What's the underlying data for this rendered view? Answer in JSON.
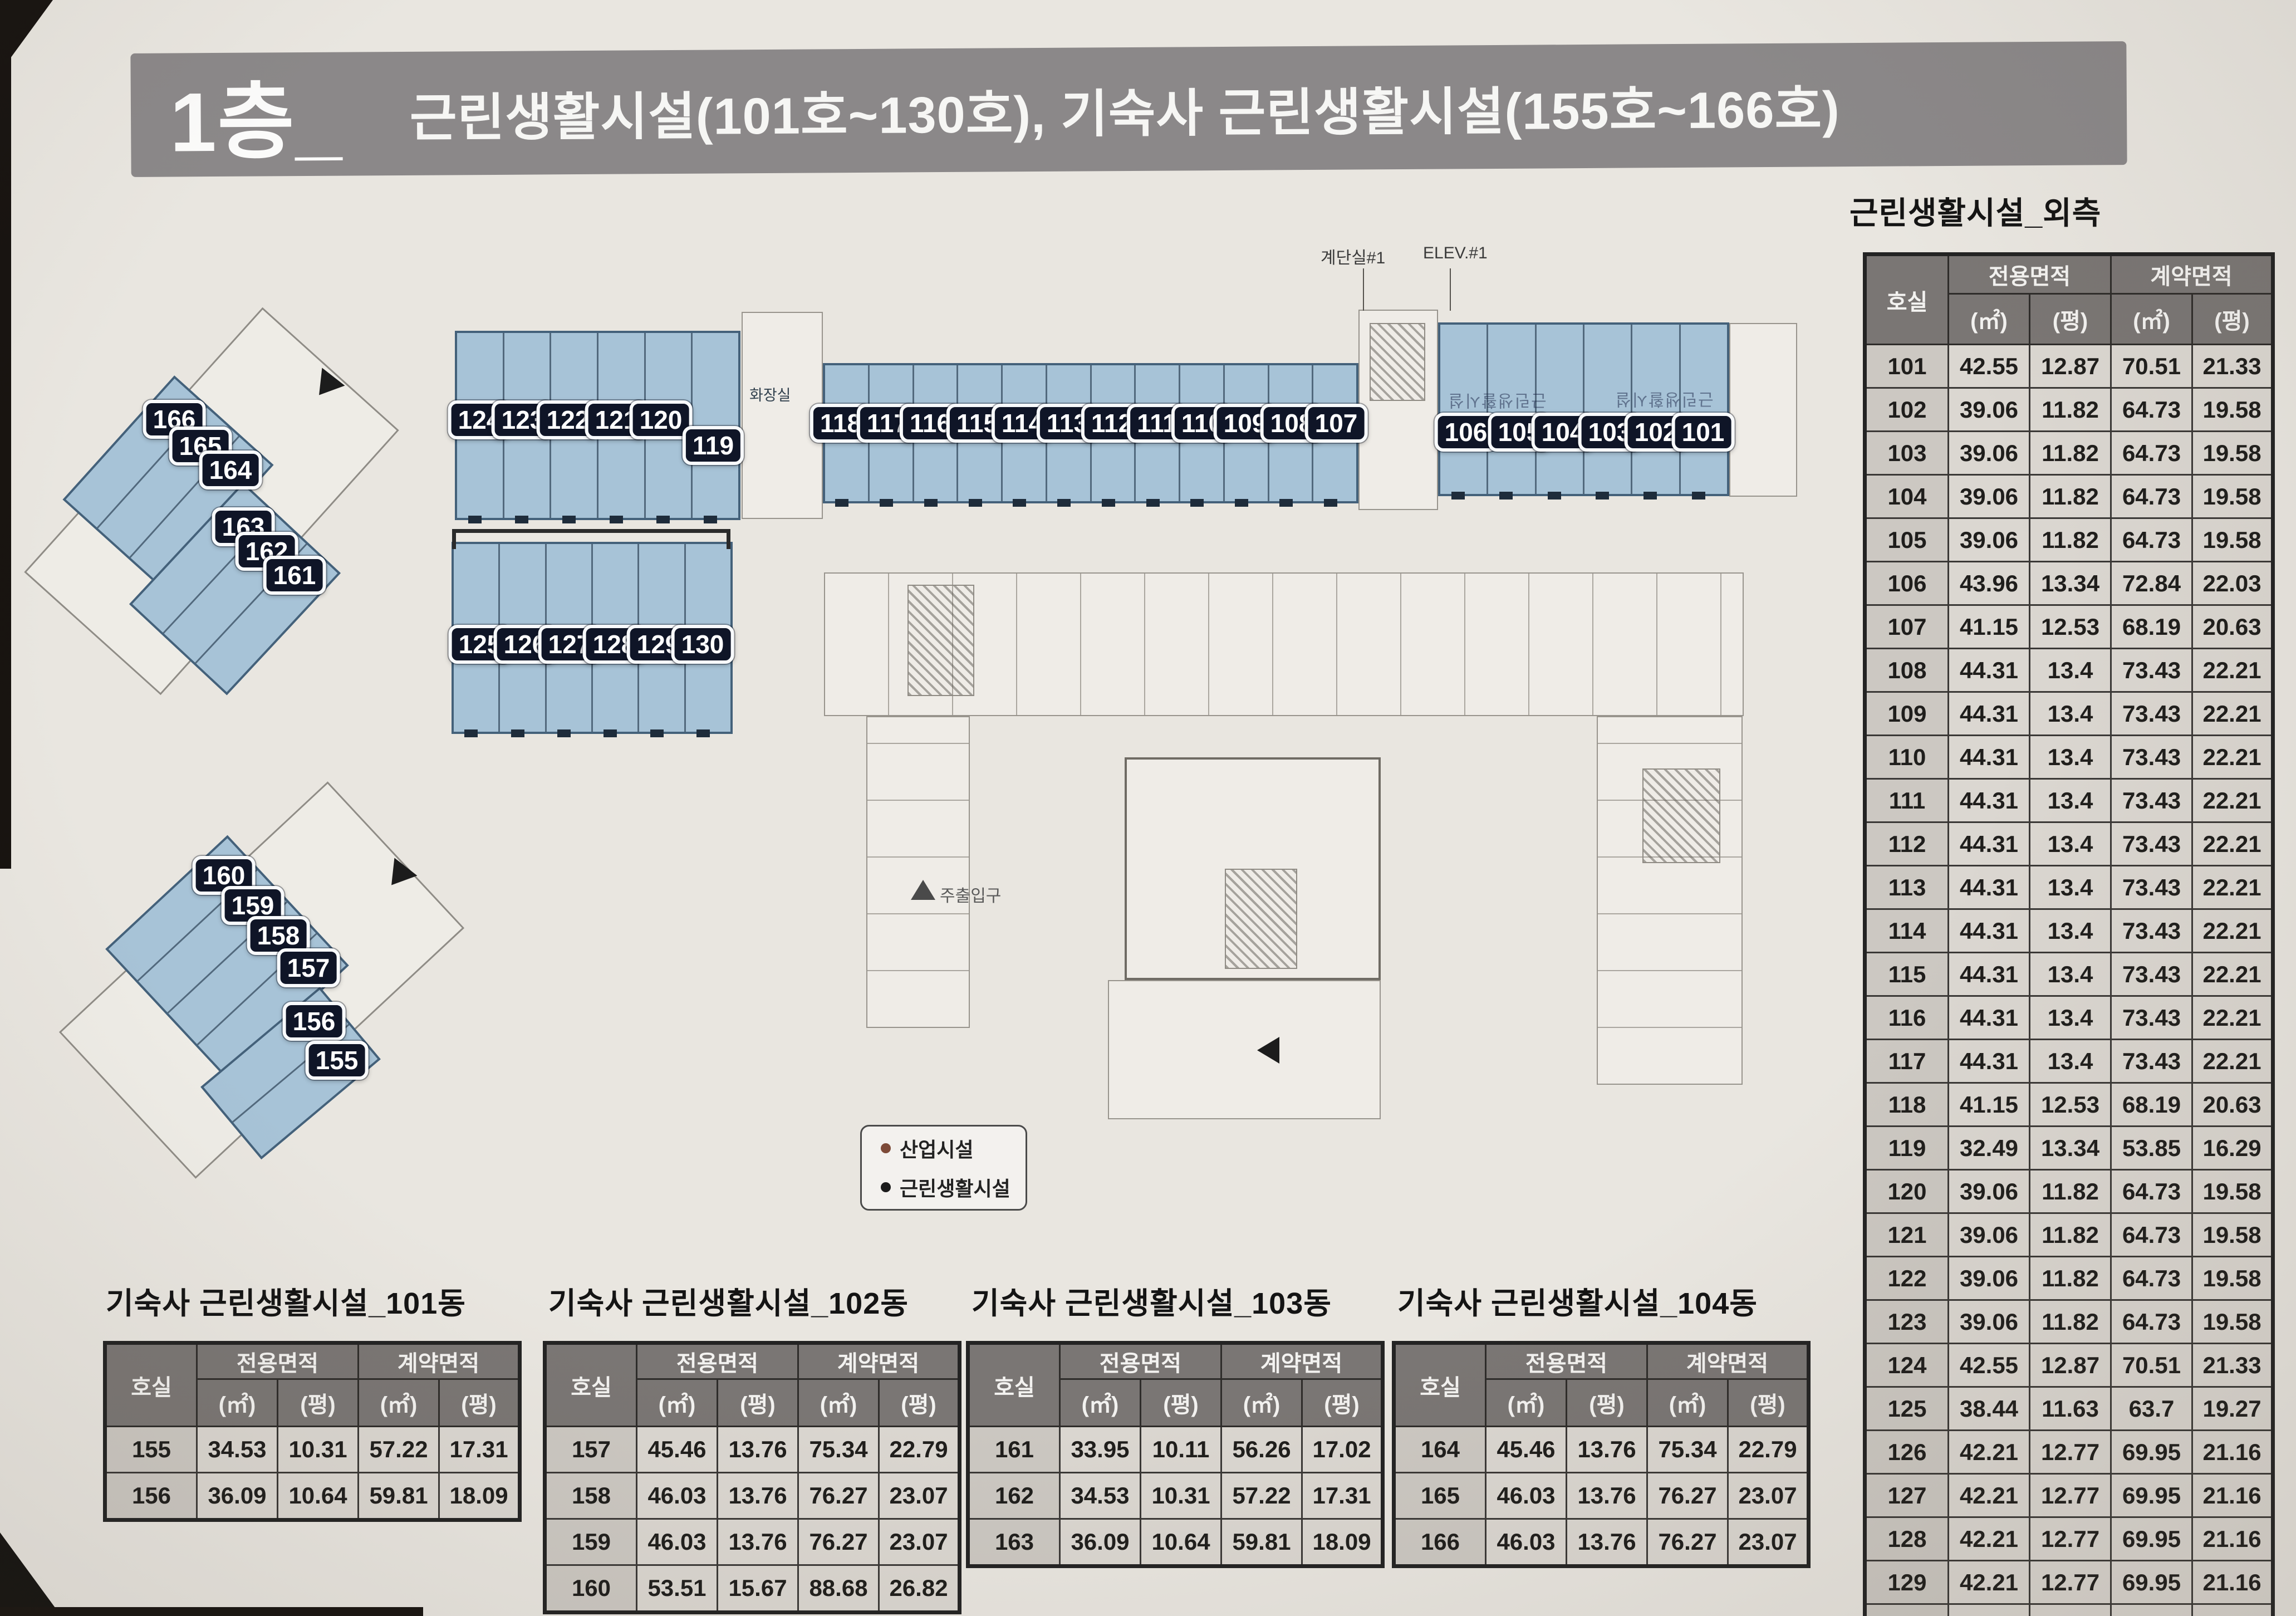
{
  "header": {
    "floor_label": "1층_",
    "title": "근린생활시설(101호~130호), 기숙사 근린생활시설(155호~166호)"
  },
  "plan": {
    "annotations": {
      "stair": "계단실#1",
      "elevator": "ELEV.#1",
      "toilet": "화장실",
      "main_entrance": "주출입구",
      "block_caption": "근린생활시설"
    },
    "legend": {
      "items": [
        {
          "label": "산업시설",
          "dot_color": "#7d4a38"
        },
        {
          "label": "근린생활시설",
          "dot_color": "#1b1b1b"
        }
      ]
    },
    "colors": {
      "room_fill": "#a7c3d7",
      "room_border": "#44617a",
      "label_bg": "#0f1527"
    },
    "blocks": {
      "top_left": [
        "124",
        "123",
        "122",
        "121",
        "120",
        "119"
      ],
      "strip": [
        "118",
        "117",
        "116",
        "115",
        "114",
        "113",
        "112",
        "111",
        "110",
        "109",
        "108",
        "107"
      ],
      "right": [
        "106",
        "105",
        "104",
        "103",
        "102",
        "101"
      ],
      "second_row": [
        "125",
        "126",
        "127",
        "128",
        "129",
        "130"
      ],
      "diag_upper": [
        "166",
        "165",
        "164",
        "163",
        "162",
        "161"
      ],
      "diag_lower": [
        "160",
        "159",
        "158",
        "157",
        "156",
        "155"
      ]
    }
  },
  "table_headers": {
    "room": "호실",
    "exclusive": "전용면적",
    "contract": "계약면적",
    "m2": "(㎡)",
    "py": "(평)"
  },
  "outer_table": {
    "title": "근린생활시설_외측",
    "rows": [
      [
        "101",
        "42.55",
        "12.87",
        "70.51",
        "21.33"
      ],
      [
        "102",
        "39.06",
        "11.82",
        "64.73",
        "19.58"
      ],
      [
        "103",
        "39.06",
        "11.82",
        "64.73",
        "19.58"
      ],
      [
        "104",
        "39.06",
        "11.82",
        "64.73",
        "19.58"
      ],
      [
        "105",
        "39.06",
        "11.82",
        "64.73",
        "19.58"
      ],
      [
        "106",
        "43.96",
        "13.34",
        "72.84",
        "22.03"
      ],
      [
        "107",
        "41.15",
        "12.53",
        "68.19",
        "20.63"
      ],
      [
        "108",
        "44.31",
        "13.4",
        "73.43",
        "22.21"
      ],
      [
        "109",
        "44.31",
        "13.4",
        "73.43",
        "22.21"
      ],
      [
        "110",
        "44.31",
        "13.4",
        "73.43",
        "22.21"
      ],
      [
        "111",
        "44.31",
        "13.4",
        "73.43",
        "22.21"
      ],
      [
        "112",
        "44.31",
        "13.4",
        "73.43",
        "22.21"
      ],
      [
        "113",
        "44.31",
        "13.4",
        "73.43",
        "22.21"
      ],
      [
        "114",
        "44.31",
        "13.4",
        "73.43",
        "22.21"
      ],
      [
        "115",
        "44.31",
        "13.4",
        "73.43",
        "22.21"
      ],
      [
        "116",
        "44.31",
        "13.4",
        "73.43",
        "22.21"
      ],
      [
        "117",
        "44.31",
        "13.4",
        "73.43",
        "22.21"
      ],
      [
        "118",
        "41.15",
        "12.53",
        "68.19",
        "20.63"
      ],
      [
        "119",
        "32.49",
        "13.34",
        "53.85",
        "16.29"
      ],
      [
        "120",
        "39.06",
        "11.82",
        "64.73",
        "19.58"
      ],
      [
        "121",
        "39.06",
        "11.82",
        "64.73",
        "19.58"
      ],
      [
        "122",
        "39.06",
        "11.82",
        "64.73",
        "19.58"
      ],
      [
        "123",
        "39.06",
        "11.82",
        "64.73",
        "19.58"
      ],
      [
        "124",
        "42.55",
        "12.87",
        "70.51",
        "21.33"
      ],
      [
        "125",
        "38.44",
        "11.63",
        "63.7",
        "19.27"
      ],
      [
        "126",
        "42.21",
        "12.77",
        "69.95",
        "21.16"
      ],
      [
        "127",
        "42.21",
        "12.77",
        "69.95",
        "21.16"
      ],
      [
        "128",
        "42.21",
        "12.77",
        "69.95",
        "21.16"
      ],
      [
        "129",
        "42.21",
        "12.77",
        "69.95",
        "21.16"
      ],
      [
        "130",
        "38.44",
        "11.63",
        "63.7",
        "19.27"
      ]
    ]
  },
  "dorm_tables": [
    {
      "title": "기숙사 근린생활시설_101동",
      "rows": [
        [
          "155",
          "34.53",
          "10.31",
          "57.22",
          "17.31"
        ],
        [
          "156",
          "36.09",
          "10.64",
          "59.81",
          "18.09"
        ]
      ]
    },
    {
      "title": "기숙사 근린생활시설_102동",
      "rows": [
        [
          "157",
          "45.46",
          "13.76",
          "75.34",
          "22.79"
        ],
        [
          "158",
          "46.03",
          "13.76",
          "76.27",
          "23.07"
        ],
        [
          "159",
          "46.03",
          "13.76",
          "76.27",
          "23.07"
        ],
        [
          "160",
          "53.51",
          "15.67",
          "88.68",
          "26.82"
        ]
      ]
    },
    {
      "title": "기숙사 근린생활시설_103동",
      "rows": [
        [
          "161",
          "33.95",
          "10.11",
          "56.26",
          "17.02"
        ],
        [
          "162",
          "34.53",
          "10.31",
          "57.22",
          "17.31"
        ],
        [
          "163",
          "36.09",
          "10.64",
          "59.81",
          "18.09"
        ]
      ]
    },
    {
      "title": "기숙사 근린생활시설_104동",
      "rows": [
        [
          "164",
          "45.46",
          "13.76",
          "75.34",
          "22.79"
        ],
        [
          "165",
          "46.03",
          "13.76",
          "76.27",
          "23.07"
        ],
        [
          "166",
          "46.03",
          "13.76",
          "76.27",
          "23.07"
        ]
      ]
    }
  ]
}
